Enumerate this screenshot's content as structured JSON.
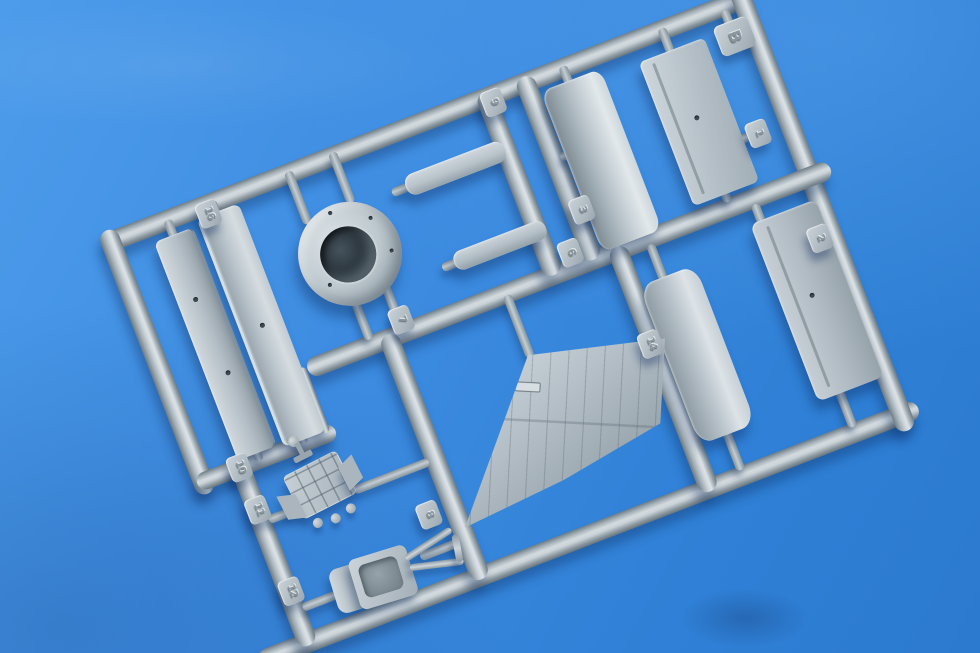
{
  "colors": {
    "backdrop_blue": "#3f8edf",
    "plastic_gray": "#b9c4cb",
    "shadow_blue": "#1c4f96",
    "intake_interior": "#2b363e"
  },
  "sprue": {
    "letter_tag": {
      "label": "B"
    },
    "tags": {
      "t1": {
        "label": "1"
      },
      "t2": {
        "label": "2"
      },
      "t3": {
        "label": "3"
      },
      "t6": {
        "label": "6"
      },
      "t7": {
        "label": "7"
      },
      "t8": {
        "label": "8"
      },
      "t9": {
        "label": "9"
      },
      "t10": {
        "label": "10"
      },
      "t11": {
        "label": "11"
      },
      "t12": {
        "label": "12"
      },
      "t14": {
        "label": "14"
      },
      "t16": {
        "label": "16"
      }
    }
  }
}
